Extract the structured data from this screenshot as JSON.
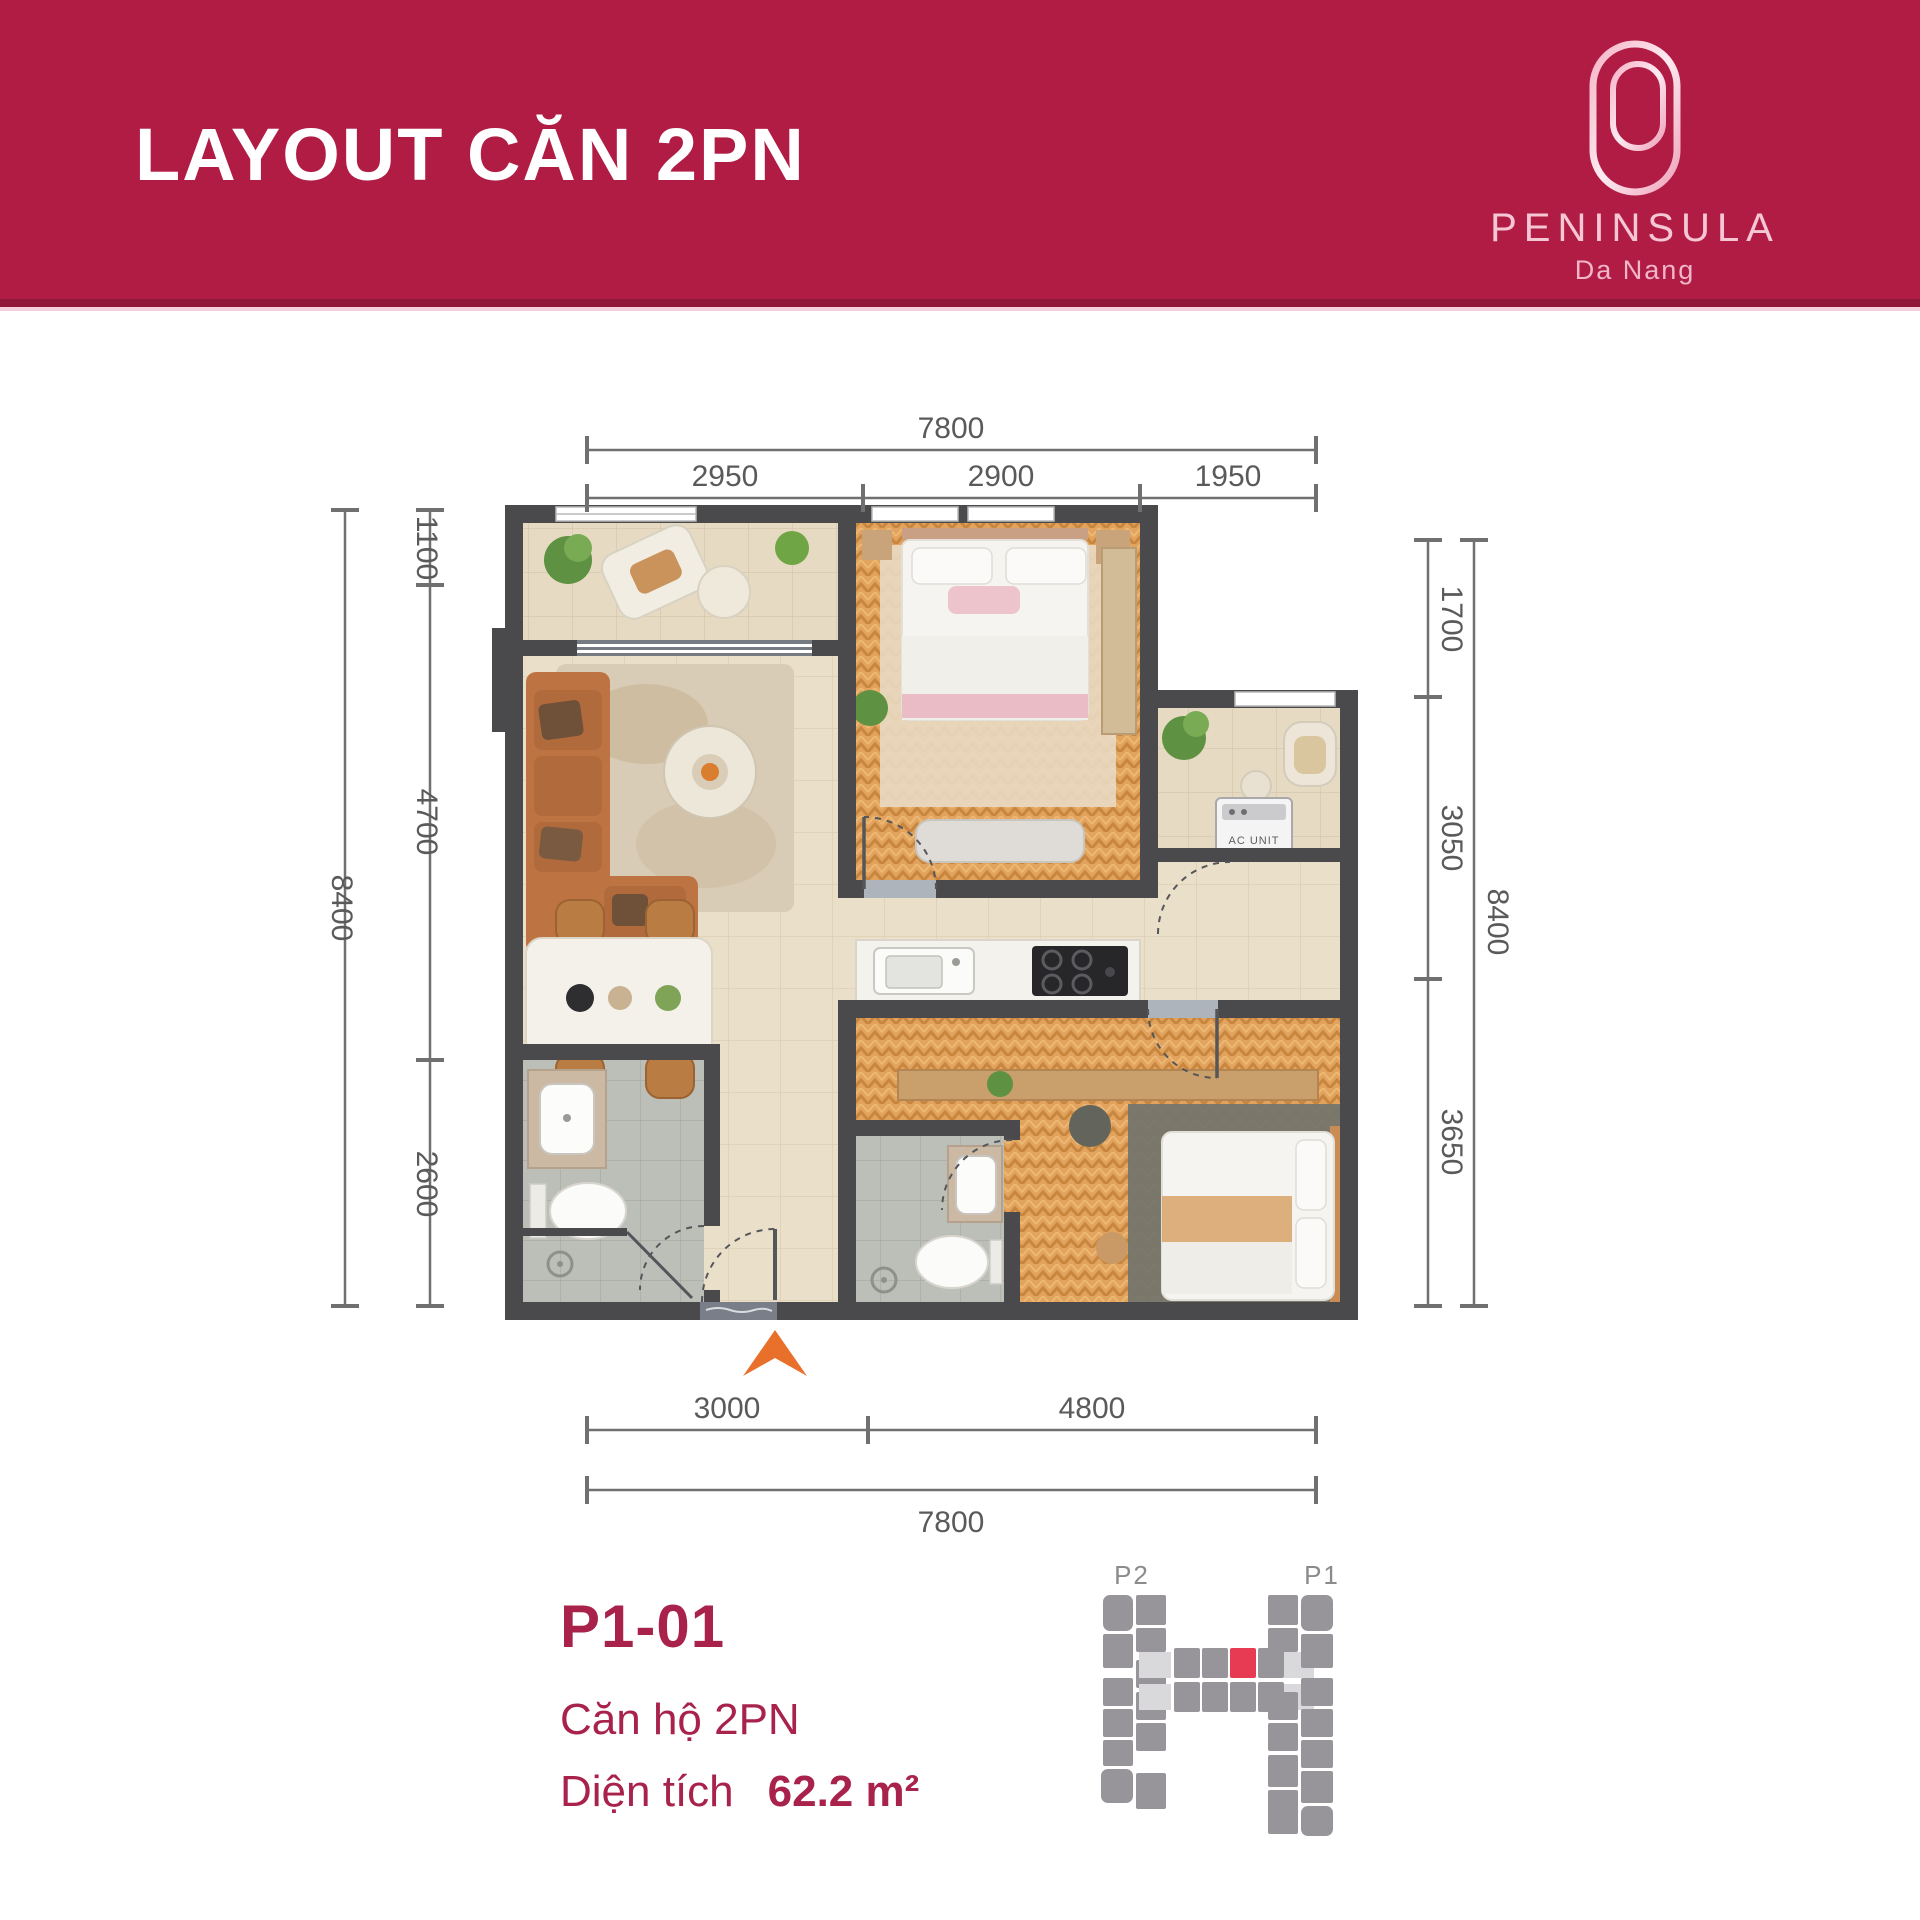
{
  "header": {
    "title": "LAYOUT CĂN 2PN",
    "brand": "PENINSULA",
    "city": "Da Nang",
    "bg_color": "#B11C45"
  },
  "plan": {
    "labels": {
      "ac_unit": "AC UNIT"
    },
    "entrance_arrow_color": "#E8702B",
    "dims": {
      "top": {
        "overall": "7800",
        "segments": [
          "2950",
          "2900",
          "1950"
        ]
      },
      "bottom": {
        "overall": "7800",
        "segments": [
          "3000",
          "4800"
        ]
      },
      "left": {
        "overall": "8400",
        "segments": [
          "1100",
          "4700",
          "2600"
        ]
      },
      "right": {
        "overall": "8400",
        "segments": [
          "1700",
          "3050",
          "3650"
        ]
      }
    }
  },
  "unit": {
    "code": "P1-01",
    "type": "Căn hộ 2PN",
    "area_label": "Diện tích",
    "area_value": "62.2 m²",
    "text_color": "#A8224B"
  },
  "key_plan": {
    "left_label": "P2",
    "right_label": "P1",
    "highlight_color": "#E63B52"
  }
}
